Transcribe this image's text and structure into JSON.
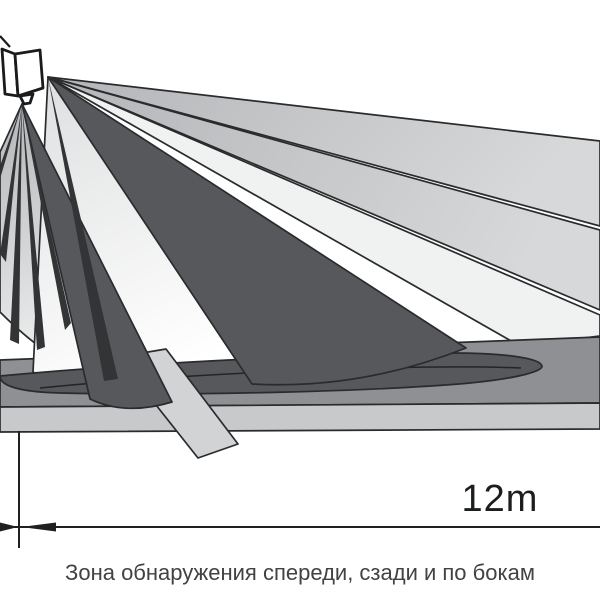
{
  "diagram": {
    "caption": "Зона обнаружения спереди, сзади и по бокам",
    "dimension": {
      "label": "12m"
    },
    "device": "pir-motion-detector",
    "colors": {
      "dark_beam": "#57585c",
      "mid_gray": "#8e9093",
      "light_gray": "#c7c9cb",
      "near_white_beam": "#f0f1f1",
      "outline": "#2a2b2d",
      "dimension_line": "#1f2021",
      "caption_text": "#414244",
      "background": "#ffffff"
    }
  }
}
